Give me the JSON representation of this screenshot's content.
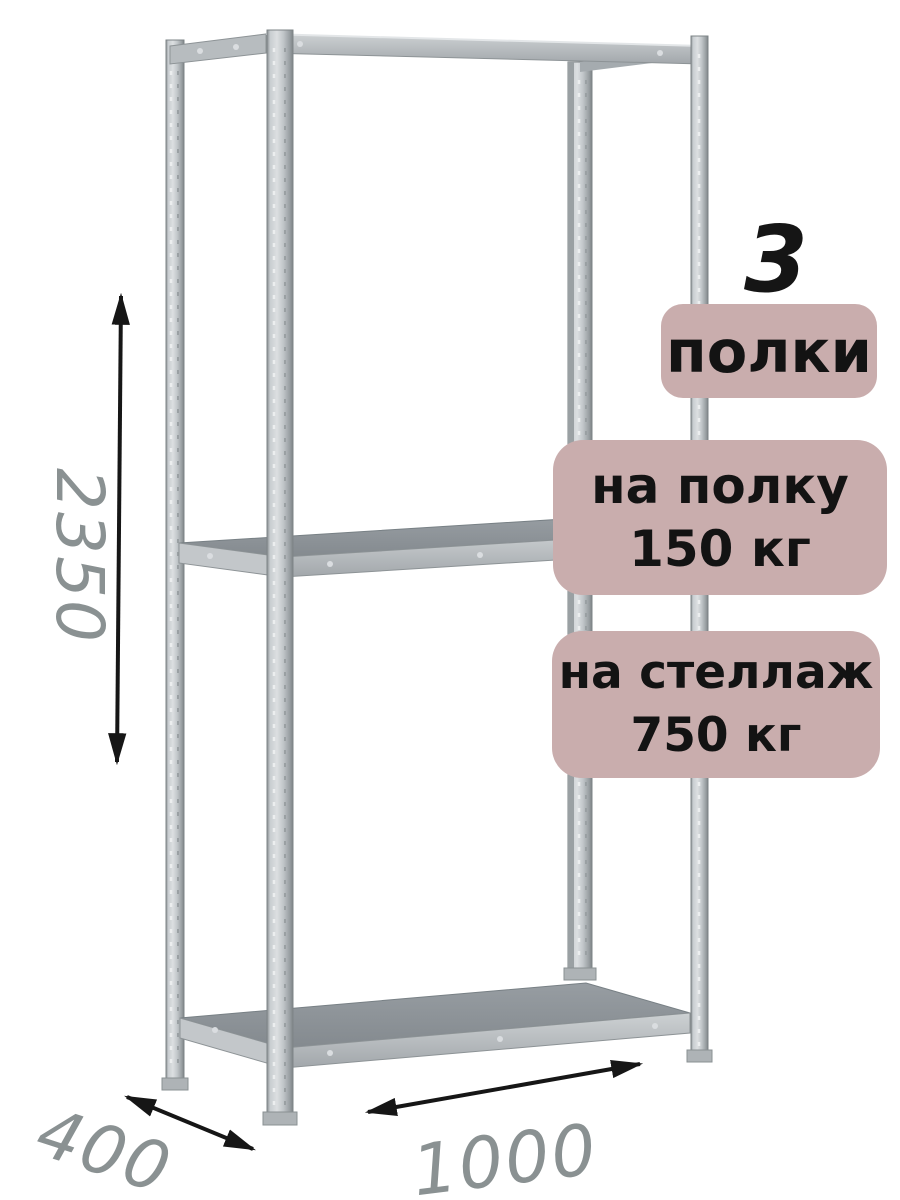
{
  "badges": {
    "shelves": {
      "count": "3",
      "label": "полки"
    },
    "per_shelf": {
      "line1": "на полку",
      "line2": "150 кг"
    },
    "per_rack": {
      "line1": "на стеллаж",
      "line2": "750 кг"
    }
  },
  "dimensions": {
    "height": "2350",
    "depth": "400",
    "width": "1000"
  },
  "colors": {
    "badge_bg": "#c9adad",
    "badge_text": "#131313",
    "dimension_label": "#8a9192",
    "arrow": "#161616",
    "metal_light": "#dcdfe1",
    "metal_mid": "#bcc1c4",
    "metal_dark": "#8f9599",
    "shelf_surface": "#8d9397"
  }
}
